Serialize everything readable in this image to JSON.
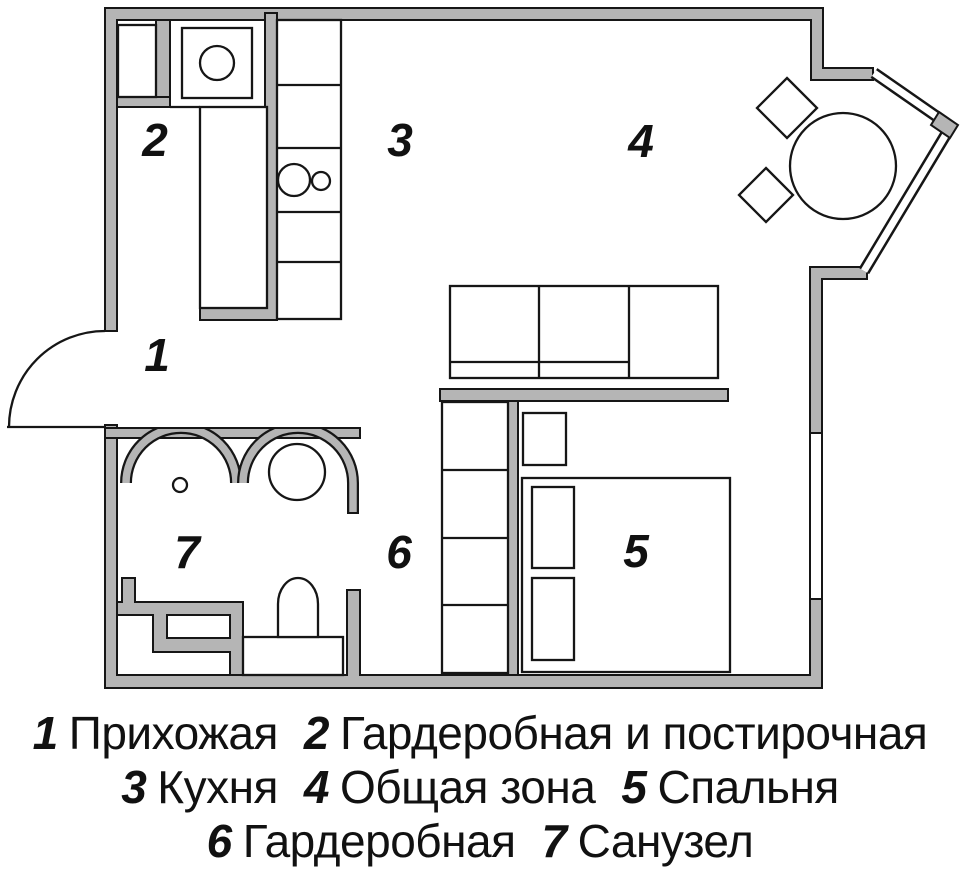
{
  "figure": {
    "kind": "apartment-floor-plan"
  },
  "colors": {
    "wall_fill": "#b5b5b5",
    "line": "#161616",
    "background": "#ffffff"
  },
  "plan": {
    "room_numbers": {
      "r1": "1",
      "r2": "2",
      "r3": "3",
      "r4": "4",
      "r5": "5",
      "r6": "6",
      "r7": "7"
    }
  },
  "legend": {
    "rows": [
      [
        {
          "num": "1",
          "label": "Прихожая"
        },
        {
          "num": "2",
          "label": "Гардеробная и постирочная"
        }
      ],
      [
        {
          "num": "3",
          "label": "Кухня"
        },
        {
          "num": "4",
          "label": "Общая зона"
        },
        {
          "num": "5",
          "label": "Спальня"
        }
      ],
      [
        {
          "num": "6",
          "label": "Гардеробная"
        },
        {
          "num": "7",
          "label": "Санузел"
        }
      ]
    ]
  }
}
